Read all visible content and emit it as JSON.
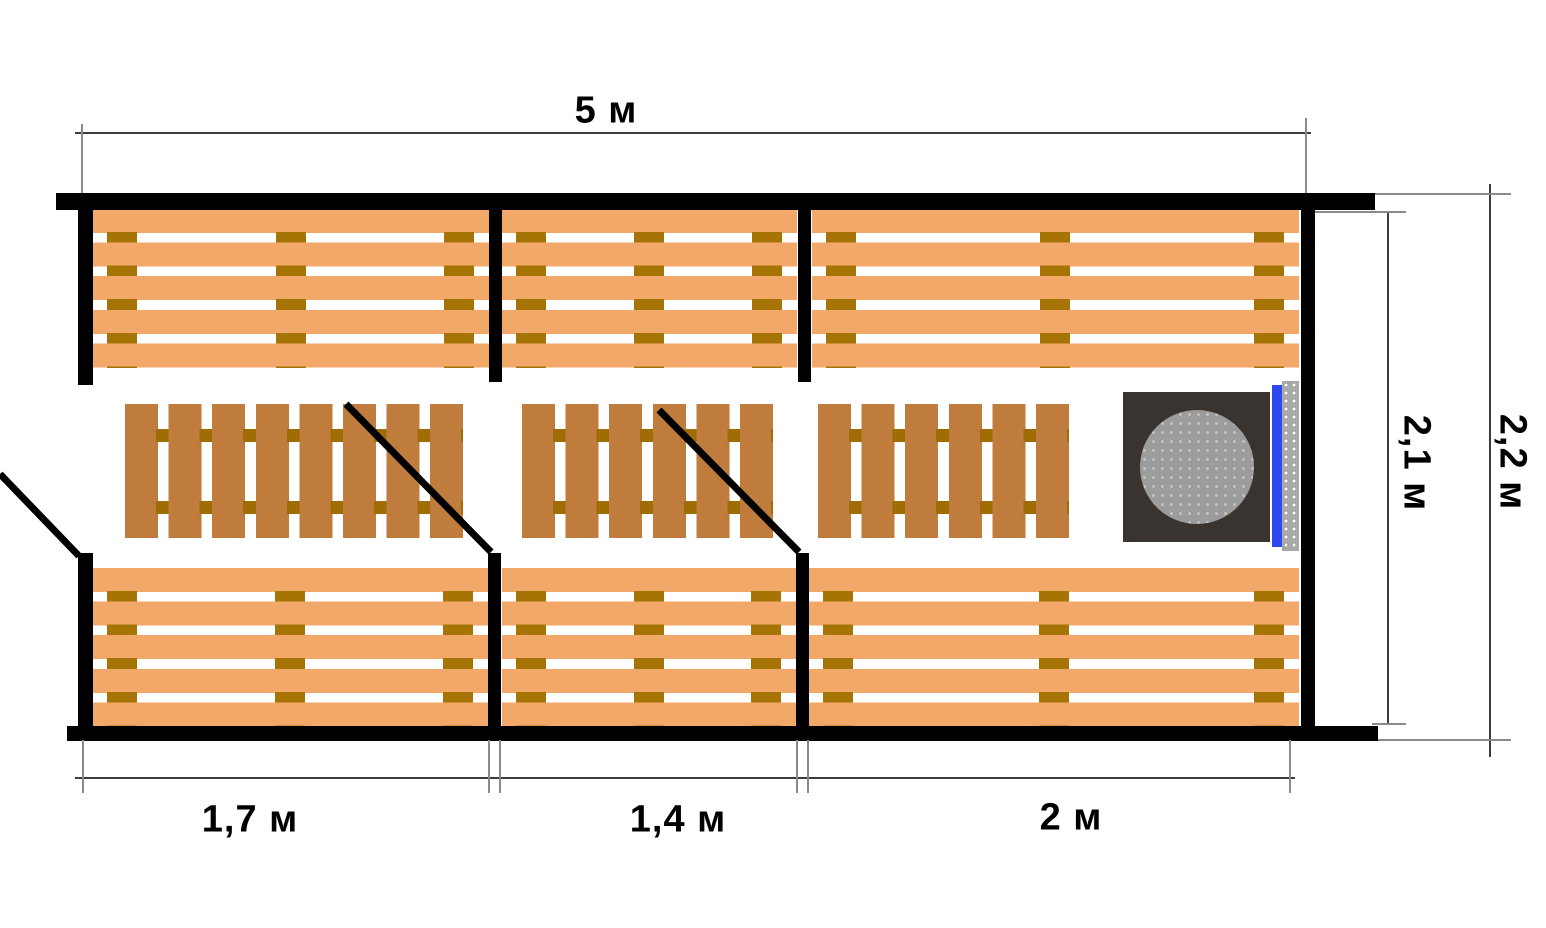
{
  "labels": {
    "width_total": "5 м",
    "room1_width": "1,7 м",
    "room2_width": "1,4 м",
    "room3_width": "2 м",
    "inner_height": "2,1 м",
    "outer_height": "2,2 м"
  },
  "colors": {
    "wall": "#000000",
    "bench_plank": "#f2a869",
    "bench_cleat": "#a57404",
    "duck_plank": "#bf7c3d",
    "duck_connector": "#a06d05",
    "stove_body": "#3a3430",
    "stove_stones": "#9c9c9c",
    "heat_shield": "#2e49f0",
    "screen": "#a8a8a8",
    "dim_line": "#3c3c3c",
    "ext_line": "#8a8a8a",
    "label_text": "#000000"
  }
}
